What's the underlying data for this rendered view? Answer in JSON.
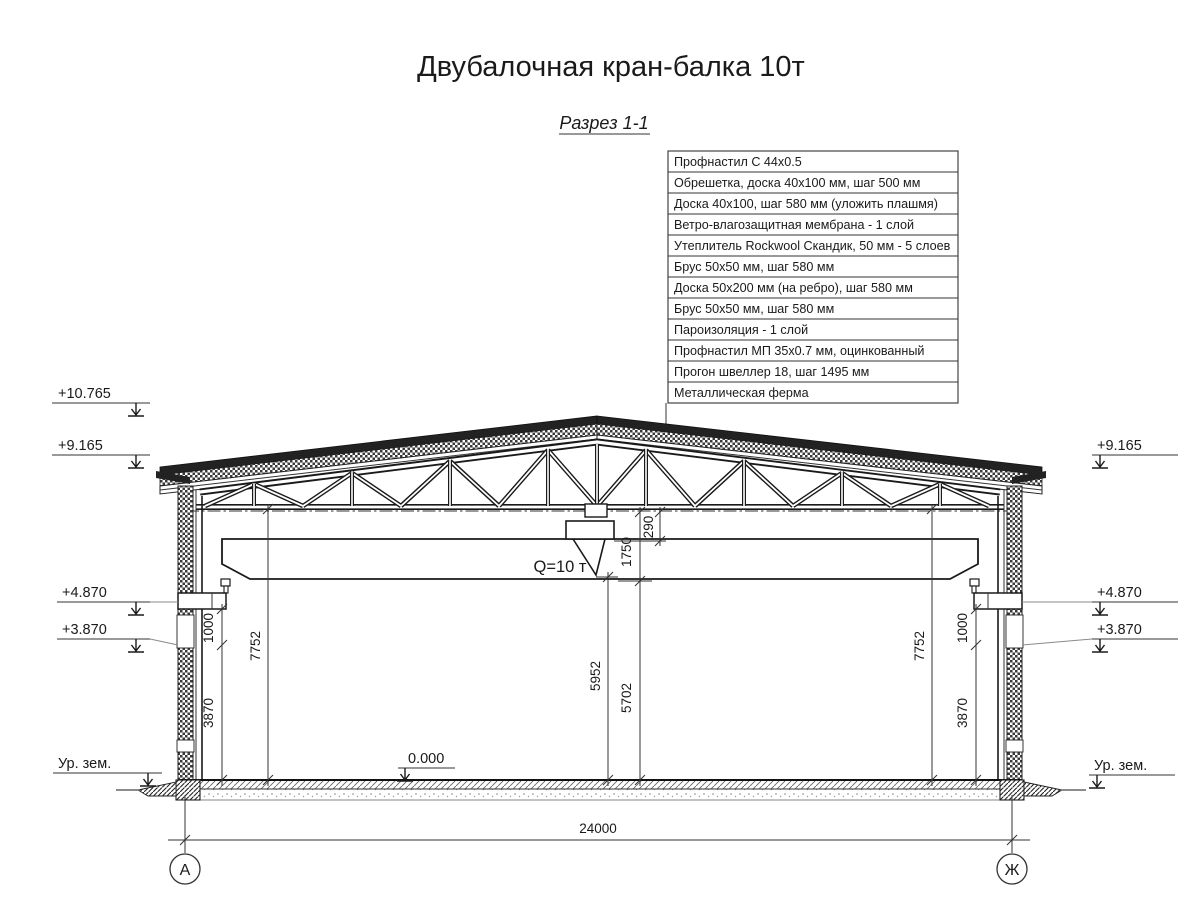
{
  "title": "Двубалочная кран-балка 10т",
  "subtitle": "Разрез 1-1",
  "spec_table": {
    "rows": [
      "Профнастил С 44х0.5",
      "Обрешетка, доска 40х100 мм, шаг 500 мм",
      "Доска 40х100, шаг 580 мм (уложить плашмя)",
      "Ветро-влагозащитная мембрана - 1 слой",
      "Утеплитель Rockwool Скандик, 50 мм - 5 слоев",
      "Брус 50х50 мм, шаг 580 мм",
      "Доска 50х200 мм (на ребро), шаг 580 мм",
      "Брус 50х50 мм, шаг 580 мм",
      "Пароизоляция - 1 слой",
      "Профнастил МП 35х0.7 мм, оцинкованный",
      "Прогон швеллер 18, шаг 1495 мм",
      "Металлическая ферма"
    ]
  },
  "crane": {
    "capacity_label": "Q=10 т"
  },
  "elevations": {
    "left_roof_top": "+10.765",
    "left_eave": "+9.165",
    "right_eave": "+9.165",
    "left_rail": "+4.870",
    "right_rail": "+4.870",
    "left_corbel": "+3.870",
    "right_corbel": "+3.870",
    "left_ground": "Ур. зем.",
    "right_ground": "Ур. зем.",
    "floor_zero": "0.000"
  },
  "dimensions": {
    "span": "24000",
    "truss_clearance_left": "7752",
    "truss_clearance_right": "7752",
    "rail_to_corbel_left": "1000",
    "rail_to_corbel_right": "1000",
    "corbel_to_floor_left": "3870",
    "corbel_to_floor_right": "3870",
    "hook_height": "5952",
    "beam_bottom_clearance": "5702",
    "beam_zone_height": "1750",
    "rail_gap": "290"
  },
  "axes": {
    "left": "А",
    "right": "Ж"
  }
}
